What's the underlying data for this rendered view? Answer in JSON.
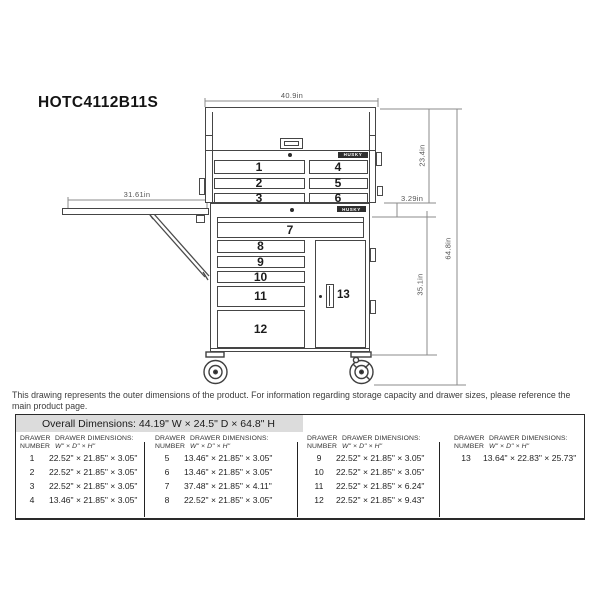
{
  "title": "HOTC4112B11S",
  "drawing": {
    "brand": "HUSKY",
    "dims": {
      "top_width": "40.9in",
      "shelf_width": "31.61in",
      "chest_height": "23.4in",
      "gap_height": "3.29in",
      "overall_height": "64.8in",
      "cabinet_height": "35.1in"
    },
    "drawer_labels": [
      "1",
      "2",
      "3",
      "4",
      "5",
      "6",
      "7",
      "8",
      "9",
      "10",
      "11",
      "12",
      "13"
    ]
  },
  "disclaimer": "This drawing represents the outer dimensions of the product. For information regarding storage capacity and drawer sizes, please reference the main product page.",
  "spec_table": {
    "overall_label": "Overall Dimensions:",
    "overall_value": "44.19\" W × 24.5\" D × 64.8\" H",
    "header": {
      "number_line1": "DRAWER",
      "number_line2": "NUMBER",
      "dims_line1": "DRAWER DIMENSIONS:",
      "dims_line2": "W\" × D\" × H\""
    },
    "groups": [
      {
        "rows": [
          {
            "num": "1",
            "dims": "22.52\" × 21.85\" × 3.05\""
          },
          {
            "num": "2",
            "dims": "22.52\" × 21.85\" × 3.05\""
          },
          {
            "num": "3",
            "dims": "22.52\" × 21.85\" × 3.05\""
          },
          {
            "num": "4",
            "dims": "13.46\" × 21.85\" × 3.05\""
          }
        ]
      },
      {
        "rows": [
          {
            "num": "5",
            "dims": "13.46\" × 21.85\" × 3.05\""
          },
          {
            "num": "6",
            "dims": "13.46\" × 21.85\" × 3.05\""
          },
          {
            "num": "7",
            "dims": "37.48\" × 21.85\" × 4.11\""
          },
          {
            "num": "8",
            "dims": "22.52\" × 21.85\" × 3.05\""
          }
        ]
      },
      {
        "rows": [
          {
            "num": "9",
            "dims": "22.52\" × 21.85\" × 3.05\""
          },
          {
            "num": "10",
            "dims": "22.52\" × 21.85\" × 3.05\""
          },
          {
            "num": "11",
            "dims": "22.52\" × 21.85\" × 6.24\""
          },
          {
            "num": "12",
            "dims": "22.52\" × 21.85\" × 9.43\""
          }
        ]
      },
      {
        "rows": [
          {
            "num": "13",
            "dims": "13.64\" × 22.83\" × 25.73\""
          }
        ]
      }
    ]
  }
}
